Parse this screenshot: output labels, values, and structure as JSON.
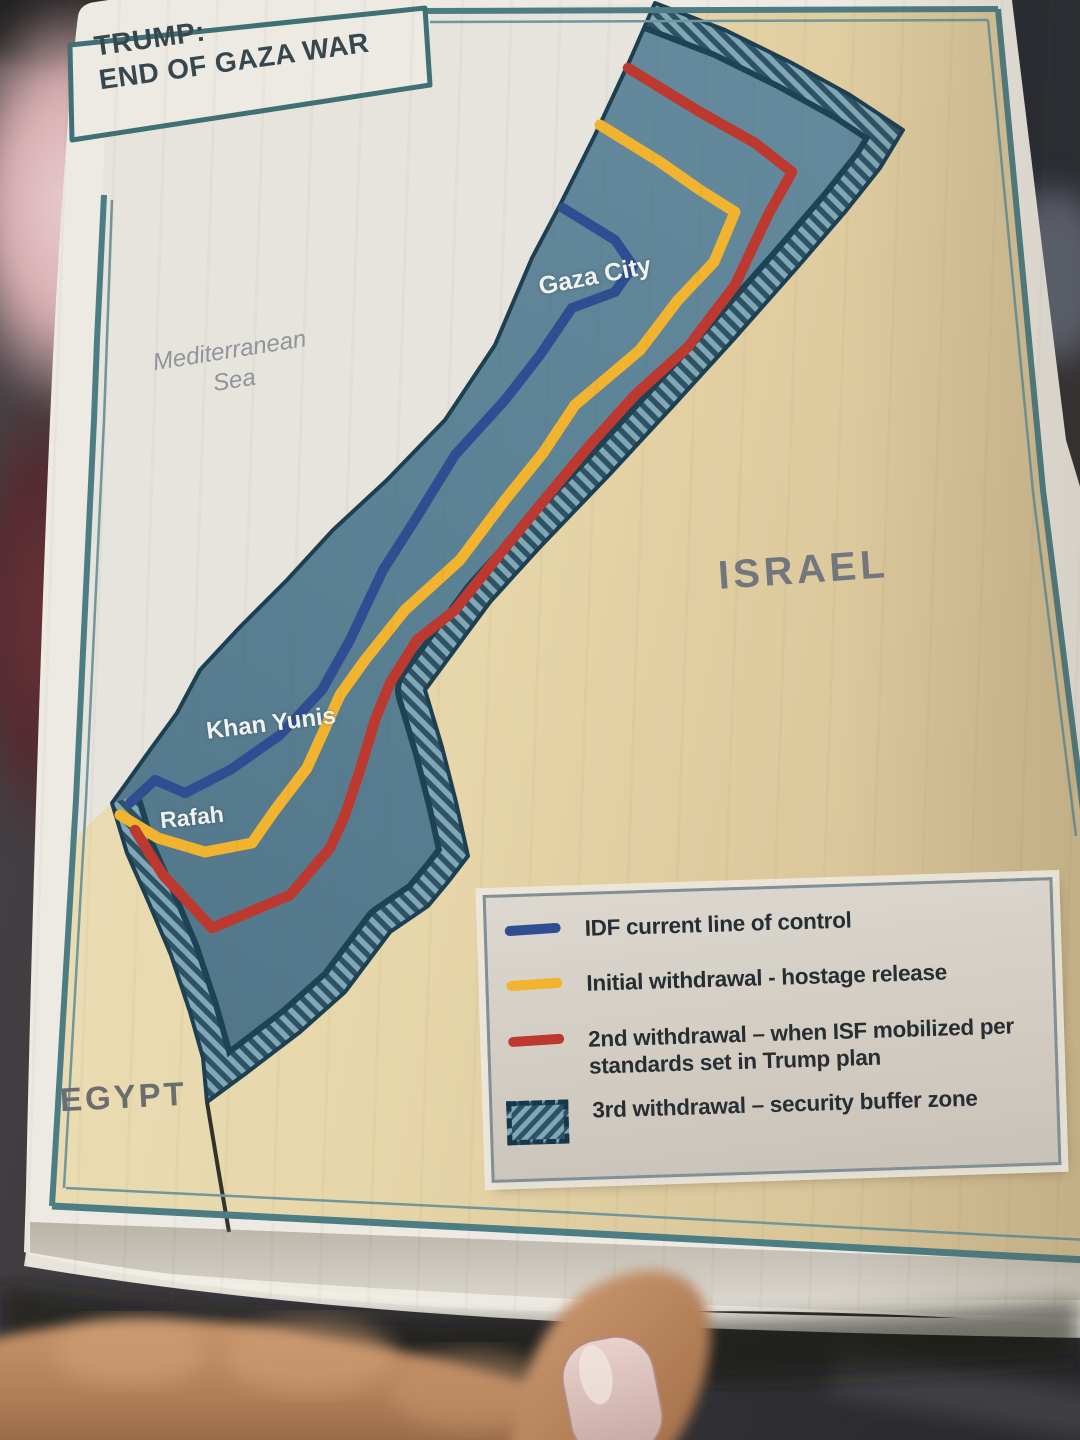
{
  "title": {
    "line1": "TRUMP:",
    "line2": "END OF GAZA WAR"
  },
  "map_labels": {
    "sea_line1": "Mediterranean",
    "sea_line2": "Sea",
    "gaza_city": "Gaza City",
    "khan_yunis": "Khan Yunis",
    "rafah": "Rafah",
    "israel": "ISRAEL",
    "egypt": "EGYPT"
  },
  "legend": {
    "items": [
      {
        "label": "IDF current line of control",
        "color": "#2f4d92",
        "swatch": "line"
      },
      {
        "label": "Initial withdrawal - hostage release",
        "color": "#f2b32e",
        "swatch": "line"
      },
      {
        "label": "2nd withdrawal – when ISF mobilized per standards set in Trump plan",
        "color": "#bd382f",
        "swatch": "line"
      },
      {
        "label": "3rd withdrawal – security buffer zone",
        "color": "#2e5164",
        "swatch": "hatch"
      }
    ]
  },
  "colors": {
    "idf_blue": "#2f4d92",
    "withdrawal_yellow": "#f2b32e",
    "withdrawal_red": "#bd382f",
    "buffer_dark": "#2e5164",
    "buffer_light": "#7fa7b5",
    "strip_fill": "#5d8194",
    "land_tan": "#e7d6a9",
    "sea_gray": "#e7e4de",
    "frame_teal": "#4c7d84"
  }
}
